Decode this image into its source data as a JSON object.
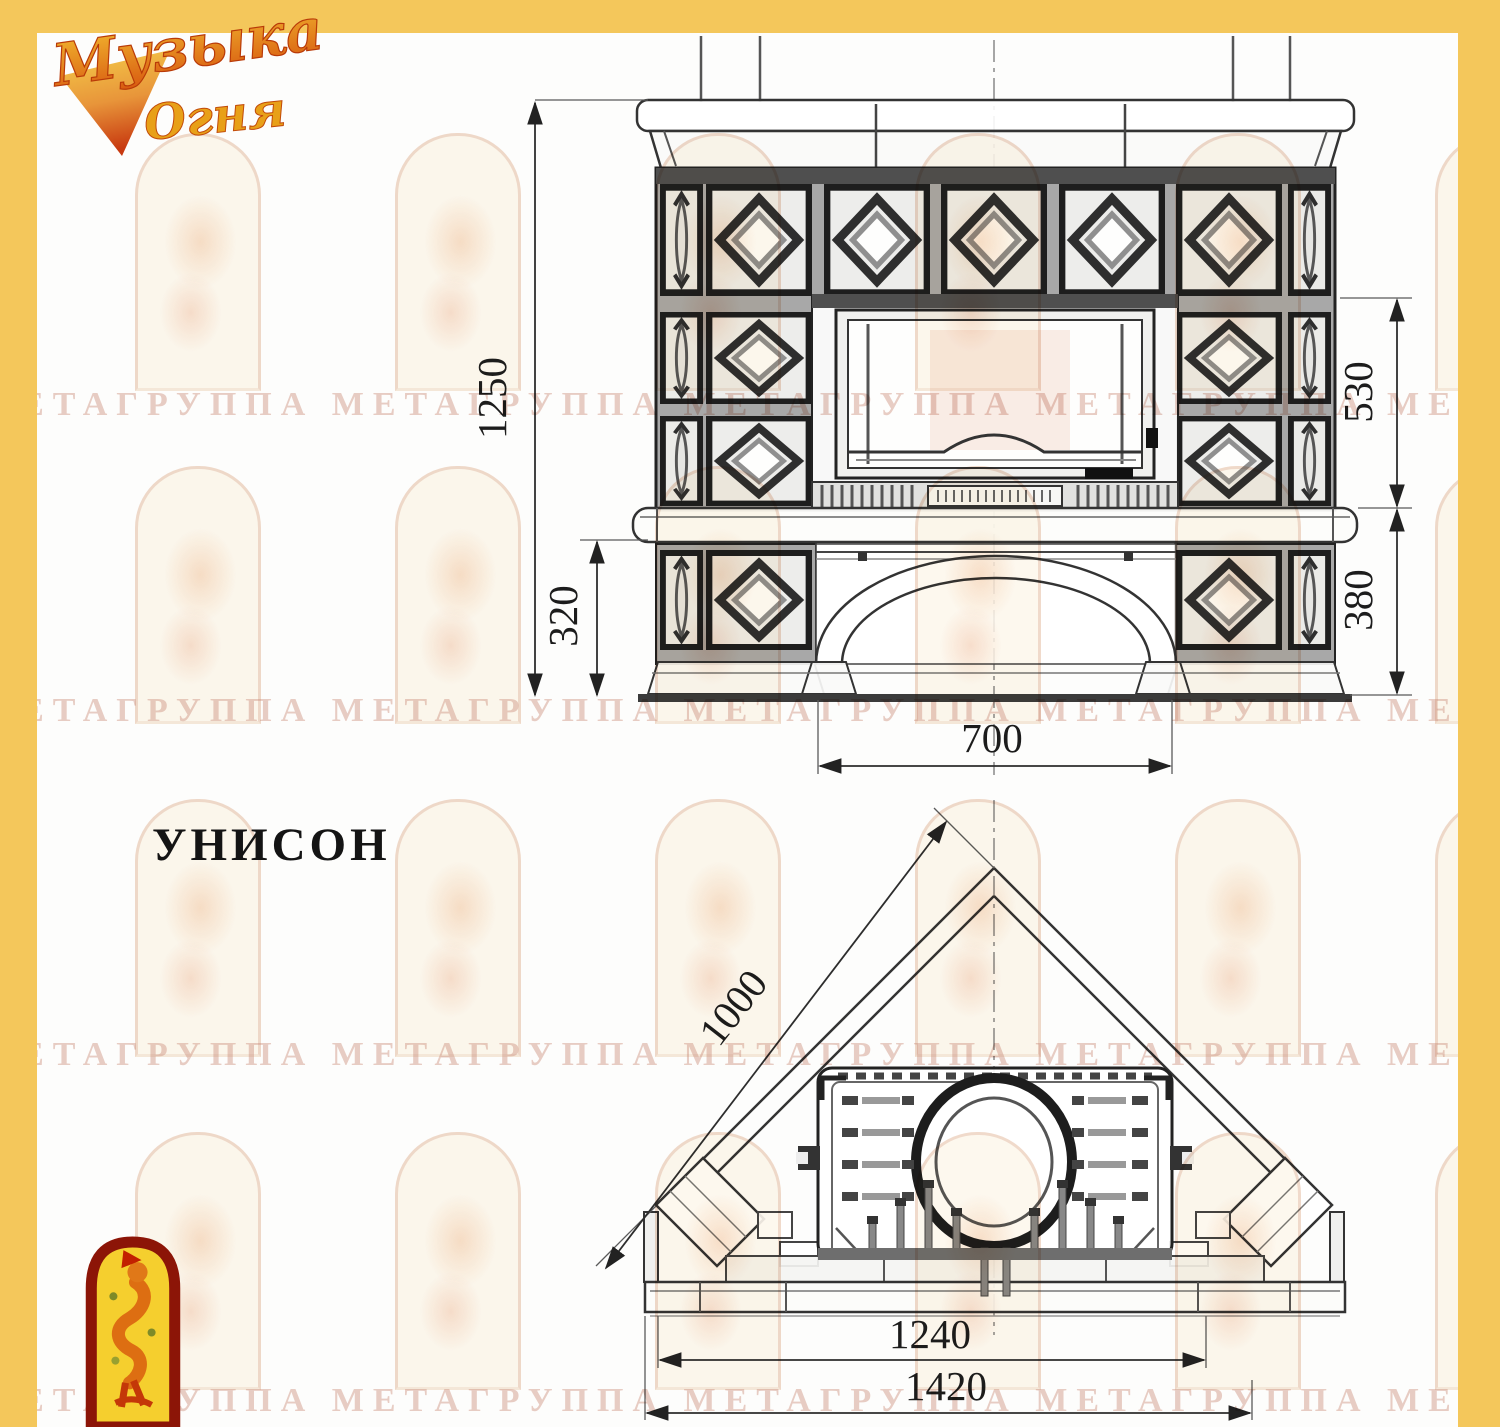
{
  "brand": {
    "line1": "Музыка",
    "line2": "Огня"
  },
  "title": "УНИСОН",
  "front_view": {
    "dim_total_height": "1250",
    "dim_firebox_height": "530",
    "dim_plinth_left": "320",
    "dim_plinth_right": "380",
    "dim_arch_width": "700"
  },
  "plan_view": {
    "dim_depth_side": "1000",
    "dim_width_inner": "1240",
    "dim_width_total": "1420"
  },
  "watermark": {
    "row_text": "МЕТАГРУППА МЕТАГРУППА МЕТАГРУППА МЕТАГРУППА МЕТАГРУППА МЕТА"
  },
  "colors": {
    "frame_yellow": "#F4C75B",
    "drawing_line": "#2d2d2d",
    "watermark_pink": "#D9947C",
    "emblem_red": "#8C1507",
    "emblem_yellow": "#F5CF2E",
    "logo_orange": "#E07818"
  }
}
